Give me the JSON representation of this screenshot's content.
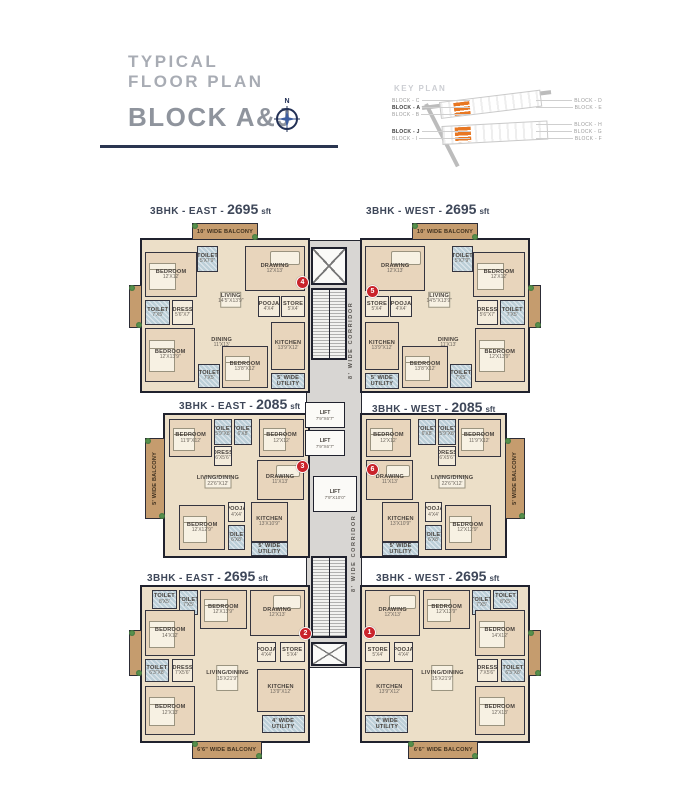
{
  "colors": {
    "accent_orange": "#e87722",
    "marker_red": "#c9232b",
    "wall": "#20222e",
    "floor_tan": "#ecdfc8",
    "balcony_brown": "#c59c6e",
    "toilet_blue": "#bccfd8",
    "corridor_gray": "#d8d6d3"
  },
  "header": {
    "title_line1": "TYPICAL",
    "title_line2": "FLOOR PLAN",
    "block_title": "BLOCK A&J",
    "compass_label": "N"
  },
  "key_plan": {
    "title": "KEY PLAN",
    "left_groups": [
      [
        {
          "label": "BLOCK - C"
        },
        {
          "label": "BLOCK - A",
          "bold": true
        },
        {
          "label": "BLOCK - B"
        }
      ],
      [
        {
          "label": "BLOCK - J",
          "bold": true
        },
        {
          "label": "BLOCK - I"
        }
      ]
    ],
    "right_groups": [
      [
        {
          "label": "BLOCK - D"
        },
        {
          "label": "BLOCK - E"
        }
      ],
      [
        {
          "label": "BLOCK - H"
        },
        {
          "label": "BLOCK - G"
        },
        {
          "label": "BLOCK - F"
        }
      ]
    ]
  },
  "corridor": {
    "label": "8' WIDE CORRIDOR",
    "strip": {
      "x": 306,
      "y": 240,
      "w": 56,
      "h": 428
    },
    "shafts": [
      {
        "x": 311,
        "y": 247,
        "w": 36,
        "h": 38
      },
      {
        "x": 311,
        "y": 642,
        "w": 36,
        "h": 24
      }
    ],
    "stairs": [
      {
        "x": 311,
        "y": 288,
        "w": 36,
        "h": 72
      },
      {
        "x": 311,
        "y": 556,
        "w": 36,
        "h": 82
      }
    ],
    "lifts": [
      {
        "label": "LIFT",
        "dims": "7'9\"X6'7\"",
        "x": 305,
        "y": 402,
        "w": 40,
        "h": 26
      },
      {
        "label": "LIFT",
        "dims": "7'9\"X6'7\"",
        "x": 305,
        "y": 430,
        "w": 40,
        "h": 26
      },
      {
        "label": "LIFT",
        "dims": "7'9\"X10'0\"",
        "x": 313,
        "y": 476,
        "w": 44,
        "h": 36
      }
    ],
    "labels": [
      {
        "x": 345,
        "y": 292,
        "w": 12,
        "h": 96
      },
      {
        "x": 348,
        "y": 505,
        "w": 12,
        "h": 96
      }
    ]
  },
  "units": [
    {
      "id": "east-top",
      "title_prefix": "3BHK - EAST -",
      "title_size": "2695",
      "title_unit": "sft",
      "box": {
        "x": 140,
        "y": 238,
        "w": 170,
        "h": 155
      },
      "title_pos": {
        "x": 150,
        "y": 201
      },
      "marker": {
        "label": "4",
        "x": 296,
        "y": 276
      },
      "rooms": [
        {
          "t": "balcony",
          "l": "10' WIDE BALCONY",
          "x": 30,
          "y": -11,
          "w": 40,
          "h": 11
        },
        {
          "t": "balcony",
          "l": "",
          "x": -8,
          "y": 30,
          "w": 8,
          "h": 28
        },
        {
          "t": "room",
          "l": "BEDROOM",
          "d": "12'X12'",
          "x": 2,
          "y": 8,
          "w": 31,
          "h": 30,
          "f": "bed"
        },
        {
          "t": "toilet",
          "l": "TOILET",
          "d": "5'X7'9\"",
          "x": 33,
          "y": 4,
          "w": 13,
          "h": 17
        },
        {
          "t": "room",
          "l": "DRAWING",
          "d": "12'X13'",
          "x": 62,
          "y": 4,
          "w": 36,
          "h": 30,
          "f": "sofa"
        },
        {
          "t": "open",
          "l": "LIVING",
          "d": "14'5\"X13'9\"",
          "x": 38,
          "y": 23,
          "w": 31,
          "h": 32,
          "f": "table"
        },
        {
          "t": "toilet",
          "l": "TOILET",
          "d": "7'X5'",
          "x": 2,
          "y": 40,
          "w": 15,
          "h": 16
        },
        {
          "t": "small",
          "l": "DRESS",
          "d": "5'6\"X7'",
          "x": 18,
          "y": 40,
          "w": 13,
          "h": 16
        },
        {
          "t": "small",
          "l": "POOJA",
          "d": "4'X4'",
          "x": 70,
          "y": 37,
          "w": 13,
          "h": 14
        },
        {
          "t": "small",
          "l": "STORE",
          "d": "5'X4'",
          "x": 84,
          "y": 37,
          "w": 14,
          "h": 14
        },
        {
          "t": "open",
          "l": "DINING",
          "d": "11'X13'",
          "x": 34,
          "y": 56,
          "w": 28,
          "h": 24
        },
        {
          "t": "room",
          "l": "BEDROOM",
          "d": "12'X13'9\"",
          "x": 2,
          "y": 58,
          "w": 30,
          "h": 36,
          "f": "bed"
        },
        {
          "t": "toilet",
          "l": "TOILET",
          "d": "7'X5'",
          "x": 34,
          "y": 82,
          "w": 13,
          "h": 16
        },
        {
          "t": "room",
          "l": "BEDROOM",
          "d": "13'8\"X12'",
          "x": 48,
          "y": 70,
          "w": 28,
          "h": 28,
          "f": "bed"
        },
        {
          "t": "room",
          "l": "KITCHEN",
          "d": "13'9\"X12'",
          "x": 78,
          "y": 54,
          "w": 20,
          "h": 32
        },
        {
          "t": "util",
          "l": "5' WIDE UTILITY",
          "x": 78,
          "y": 88,
          "w": 20,
          "h": 11
        }
      ]
    },
    {
      "id": "west-top",
      "title_prefix": "3BHK - WEST -",
      "title_size": "2695",
      "title_unit": "sft",
      "box": {
        "x": 360,
        "y": 238,
        "w": 170,
        "h": 155
      },
      "title_pos": {
        "x": 366,
        "y": 201
      },
      "marker": {
        "label": "5",
        "x": 366,
        "y": 285
      },
      "mirror_of": 0
    },
    {
      "id": "east-mid",
      "title_prefix": "3BHK - EAST -",
      "title_size": "2085",
      "title_unit": "sft",
      "box": {
        "x": 163,
        "y": 413,
        "w": 147,
        "h": 145
      },
      "title_pos": {
        "x": 179,
        "y": 396
      },
      "marker": {
        "label": "3",
        "x": 296,
        "y": 460
      },
      "rooms": [
        {
          "t": "balcony",
          "l": "5' WIDE BALCONY",
          "x": -14,
          "y": 16,
          "w": 14,
          "h": 58,
          "vert": true
        },
        {
          "t": "room",
          "l": "BEDROOM",
          "d": "11'9\"X12'",
          "x": 3,
          "y": 3,
          "w": 30,
          "h": 27,
          "f": "bed"
        },
        {
          "t": "toilet",
          "l": "TOILET",
          "d": "5'9\"X8'",
          "x": 34,
          "y": 3,
          "w": 13,
          "h": 18
        },
        {
          "t": "toilet",
          "l": "TOILET",
          "d": "6'X8'",
          "x": 48,
          "y": 3,
          "w": 13,
          "h": 18
        },
        {
          "t": "room",
          "l": "BEDROOM",
          "d": "12'X12'",
          "x": 66,
          "y": 3,
          "w": 31,
          "h": 27,
          "f": "bed"
        },
        {
          "t": "small",
          "l": "DRESS",
          "d": "6'X5'6\"",
          "x": 34,
          "y": 22,
          "w": 13,
          "h": 14
        },
        {
          "t": "open",
          "l": "LIVING/DINING",
          "d": "22'6\"X12'",
          "x": 14,
          "y": 34,
          "w": 46,
          "h": 26,
          "f": "table"
        },
        {
          "t": "room",
          "l": "DRAWING",
          "d": "11'X13'",
          "x": 64,
          "y": 32,
          "w": 33,
          "h": 28,
          "f": "sofa"
        },
        {
          "t": "room",
          "l": "BEDROOM",
          "d": "12'X12'9\"",
          "x": 10,
          "y": 64,
          "w": 32,
          "h": 32,
          "f": "bed"
        },
        {
          "t": "small",
          "l": "POOJA",
          "d": "4'X4'",
          "x": 44,
          "y": 62,
          "w": 12,
          "h": 14
        },
        {
          "t": "toilet",
          "l": "TOILET",
          "d": "6'X8'",
          "x": 44,
          "y": 78,
          "w": 12,
          "h": 18
        },
        {
          "t": "room",
          "l": "KITCHEN",
          "d": "13'X10'9\"",
          "x": 60,
          "y": 62,
          "w": 26,
          "h": 28
        },
        {
          "t": "util",
          "l": "5' WIDE UTILITY",
          "x": 60,
          "y": 90,
          "w": 26,
          "h": 10
        }
      ]
    },
    {
      "id": "west-mid",
      "title_prefix": "3BHK - WEST -",
      "title_size": "2085",
      "title_unit": "sft",
      "box": {
        "x": 360,
        "y": 413,
        "w": 147,
        "h": 145
      },
      "title_pos": {
        "x": 372,
        "y": 399
      },
      "marker": {
        "label": "6",
        "x": 366,
        "y": 463
      },
      "mirror_of": 2
    },
    {
      "id": "east-bottom",
      "title_prefix": "3BHK - EAST -",
      "title_size": "2695",
      "title_unit": "sft",
      "box": {
        "x": 140,
        "y": 585,
        "w": 170,
        "h": 158
      },
      "title_pos": {
        "x": 147,
        "y": 568
      },
      "marker": {
        "label": "2",
        "x": 299,
        "y": 627
      },
      "rooms": [
        {
          "t": "toilet",
          "l": "TOILET",
          "d": "8'X5'",
          "x": 6,
          "y": 2,
          "w": 15,
          "h": 12
        },
        {
          "t": "toilet",
          "l": "TOILET",
          "d": "7'X5'",
          "x": 22,
          "y": 2,
          "w": 12,
          "h": 16
        },
        {
          "t": "room",
          "l": "BEDROOM",
          "d": "14'X12'",
          "x": 2,
          "y": 15,
          "w": 30,
          "h": 30,
          "f": "bed"
        },
        {
          "t": "room",
          "l": "BEDROOM",
          "d": "12'X13'9\"",
          "x": 35,
          "y": 2,
          "w": 28,
          "h": 25,
          "f": "bed"
        },
        {
          "t": "room",
          "l": "DRAWING",
          "d": "12'X13'",
          "x": 65,
          "y": 2,
          "w": 33,
          "h": 30,
          "f": "sofa"
        },
        {
          "t": "toilet",
          "l": "TOILET",
          "d": "6'3\"X8'",
          "x": 2,
          "y": 47,
          "w": 14,
          "h": 15
        },
        {
          "t": "small",
          "l": "DRESS",
          "d": "7'X5'6\"",
          "x": 18,
          "y": 47,
          "w": 13,
          "h": 15
        },
        {
          "t": "room",
          "l": "BEDROOM",
          "d": "12'X13'",
          "x": 2,
          "y": 64,
          "w": 30,
          "h": 32,
          "f": "bed"
        },
        {
          "t": "open",
          "l": "LIVING/DINING",
          "d": "15'X21'9\"",
          "x": 36,
          "y": 32,
          "w": 31,
          "h": 52,
          "f": "table"
        },
        {
          "t": "small",
          "l": "POOJA",
          "d": "4'X4'",
          "x": 69,
          "y": 36,
          "w": 12,
          "h": 13
        },
        {
          "t": "small",
          "l": "STORE",
          "d": "5'X4'",
          "x": 83,
          "y": 36,
          "w": 15,
          "h": 13
        },
        {
          "t": "room",
          "l": "KITCHEN",
          "d": "13'9\"X12'",
          "x": 69,
          "y": 53,
          "w": 29,
          "h": 28
        },
        {
          "t": "util",
          "l": "4' WIDE UTILITY",
          "x": 72,
          "y": 83,
          "w": 26,
          "h": 12
        },
        {
          "t": "balcony",
          "l": "6'6\" WIDE BALCONY",
          "x": 30,
          "y": 100,
          "w": 42,
          "h": 12
        },
        {
          "t": "balcony",
          "l": "",
          "x": -8,
          "y": 28,
          "w": 8,
          "h": 30
        }
      ]
    },
    {
      "id": "west-bottom",
      "title_prefix": "3BHK - WEST -",
      "title_size": "2695",
      "title_unit": "sft",
      "box": {
        "x": 360,
        "y": 585,
        "w": 170,
        "h": 158
      },
      "title_pos": {
        "x": 376,
        "y": 568
      },
      "marker": {
        "label": "1",
        "x": 363,
        "y": 626
      },
      "mirror_of": 4
    }
  ]
}
